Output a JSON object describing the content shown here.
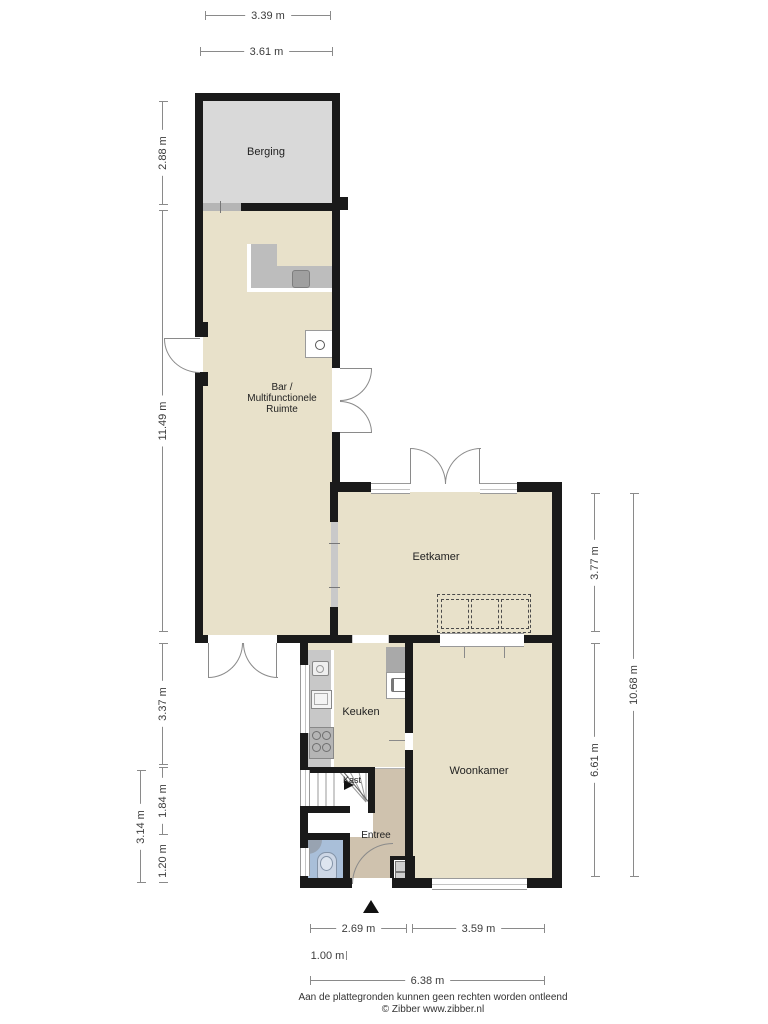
{
  "rooms": {
    "berging": "Berging",
    "bar": "Bar /\nMultifunctionele\nRuimte",
    "eetkamer": "Eetkamer",
    "keuken": "Keuken",
    "kast": "Kast",
    "entree": "Entree",
    "woonkamer": "Woonkamer"
  },
  "dimensions": {
    "top_inner": "3.39 m",
    "top_outer": "3.61 m",
    "berging_height": "2.88 m",
    "bar_height": "11.49 m",
    "keuken_height": "3.37 m",
    "hal_height": "1.84 m",
    "toilet_height": "1.20 m",
    "lower_left_total": "3.14 m",
    "eetkamer_height": "3.77 m",
    "woonkamer_height": "6.61 m",
    "right_total": "10.68 m",
    "entree_width": "2.69 m",
    "woonkamer_width": "3.59 m",
    "small_width": "1.00 m",
    "bottom_total": "6.38 m"
  },
  "fixtures": [
    "bar-counter",
    "bar-sink",
    "boiler",
    "kitchen-counter",
    "kitchen-faucet",
    "kitchen-sink",
    "stove",
    "fridge",
    "oven",
    "wardrobe-cabinets",
    "stairs",
    "toilet",
    "corner-sink",
    "meter-cupboard",
    "north-arrow"
  ],
  "footer": {
    "line1": "Aan de plattegronden kunnen geen rechten worden ontleend",
    "line2": "© Zibber www.zibber.nl"
  },
  "colors": {
    "room_fill": "#e8e1ca",
    "storage_fill": "#d9d9d9",
    "hall_fill": "#cfc2ae",
    "toilet_fill": "#a9bfd9",
    "counter_fill": "#bdbdbd",
    "wall": "#1a1a1a",
    "dim_line": "#8a8a8a",
    "text": "#222222"
  }
}
